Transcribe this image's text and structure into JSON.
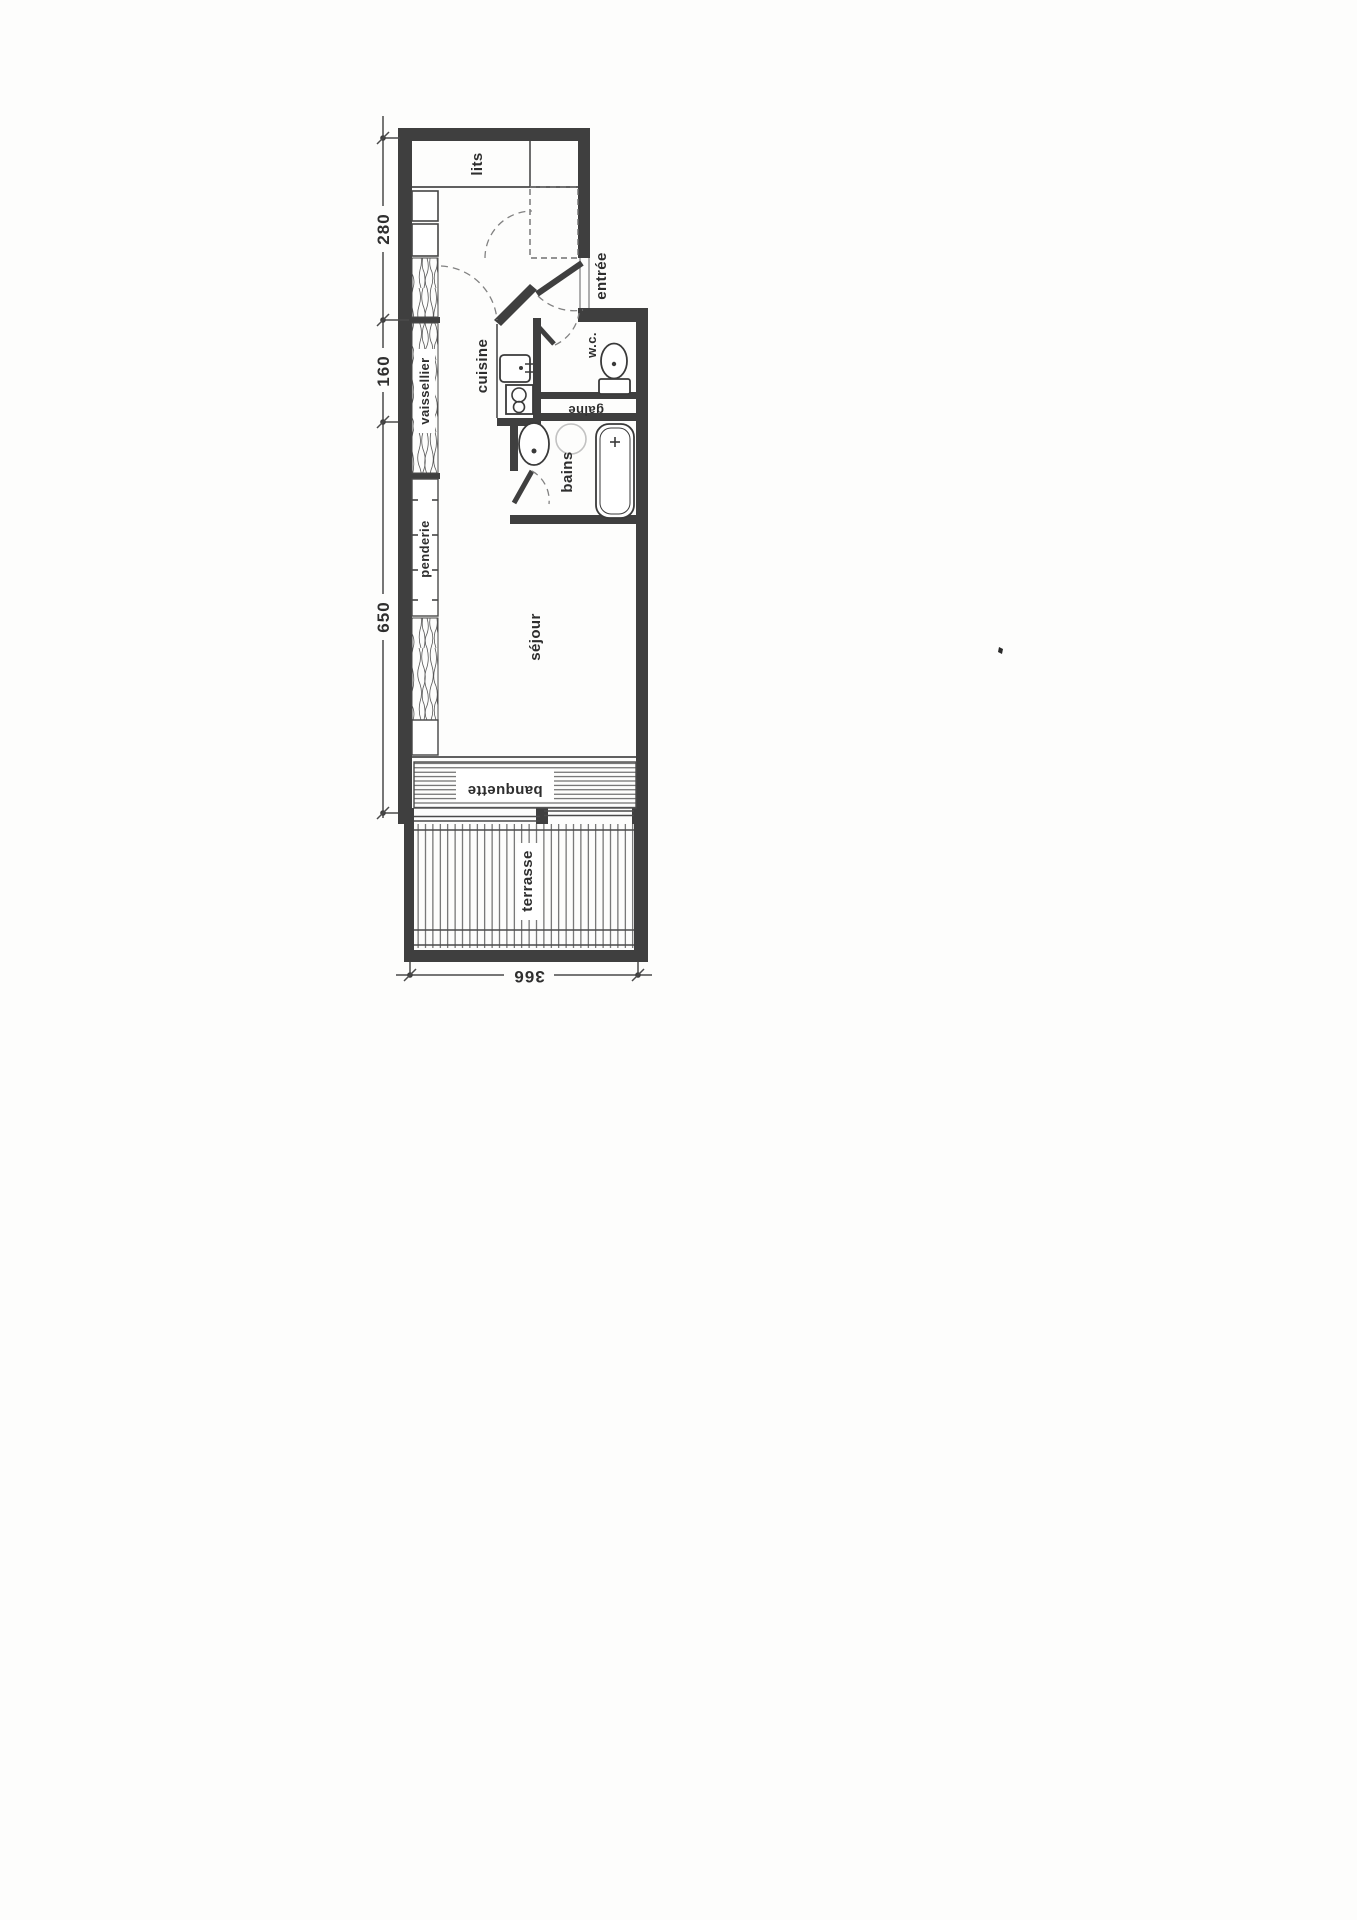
{
  "document": {
    "kind": "scanned apartment floor plan",
    "language": "fr"
  },
  "plan": {
    "rooms": [
      {
        "id": "lits",
        "label": "lits"
      },
      {
        "id": "entree",
        "label": "entrée"
      },
      {
        "id": "cuisine",
        "label": "cuisine"
      },
      {
        "id": "wc",
        "label": "w.c."
      },
      {
        "id": "gaine",
        "label": "gaine"
      },
      {
        "id": "vaissellier",
        "label": "vaissellier"
      },
      {
        "id": "bains",
        "label": "bains"
      },
      {
        "id": "penderie",
        "label": "penderie"
      },
      {
        "id": "sejour",
        "label": "séjour"
      },
      {
        "id": "banquette",
        "label": "banquette"
      },
      {
        "id": "terrasse",
        "label": "terrasse"
      }
    ],
    "dimensions": {
      "left": [
        {
          "value": "280"
        },
        {
          "value": "160"
        },
        {
          "value": "650"
        }
      ],
      "bottom": [
        {
          "value": "366"
        }
      ]
    },
    "fixtures": [
      "kitchen-sink",
      "stove",
      "toilet",
      "washbasin",
      "bathtub",
      "entrance-door",
      "wc-door",
      "bath-door",
      "sliding-glass-door",
      "wardrobe-closet",
      "dresser-cabinet",
      "bench-seat",
      "terrace-deck"
    ],
    "colors": {
      "wall": "#3f3f3f",
      "line": "#4a4a4a",
      "dash": "#828282",
      "paper": "#fdfdfc",
      "text": "#2e2e2e"
    }
  }
}
